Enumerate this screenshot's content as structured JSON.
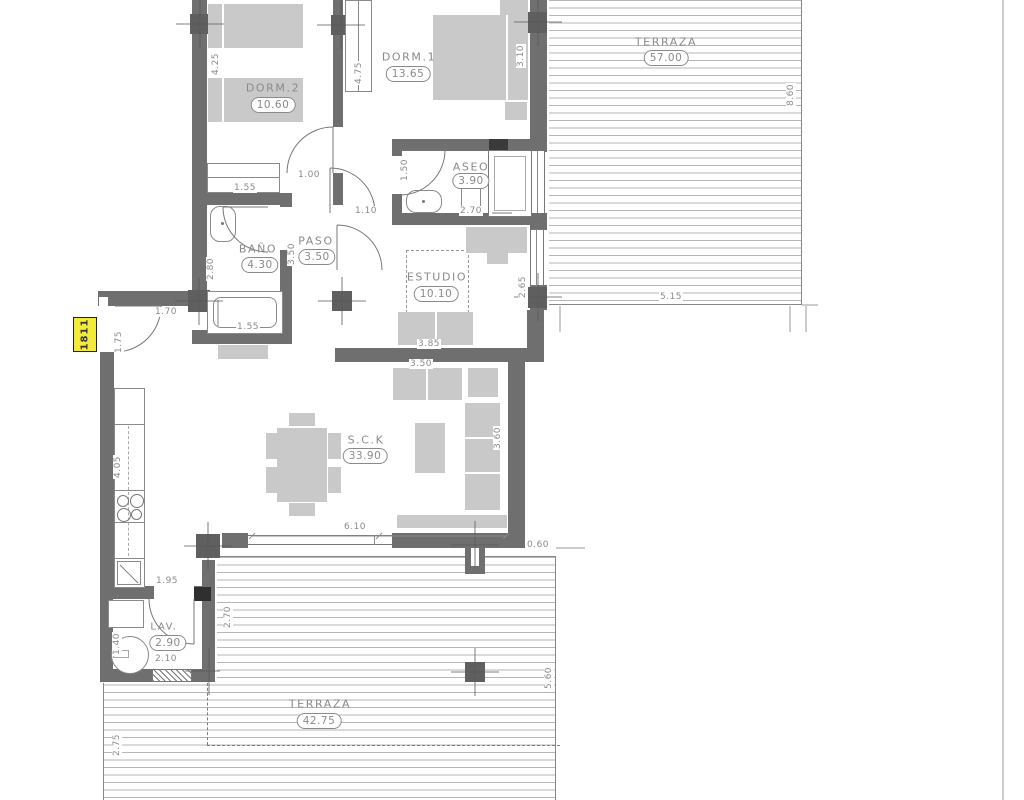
{
  "plan": {
    "unit_tag": "1811",
    "rooms": {
      "dorm2": {
        "name": "DORM.2",
        "area": "10.60"
      },
      "dorm1": {
        "name": "DORM.1",
        "area": "13.65"
      },
      "terraza_top": {
        "name": "TERRAZA",
        "area": "57.00"
      },
      "aseo": {
        "name": "ASEO",
        "area": "3.90"
      },
      "bano": {
        "name": "BAÑO",
        "area": "4.30"
      },
      "paso": {
        "name": "PASO",
        "area": "3.50"
      },
      "estudio": {
        "name": "ESTUDIO",
        "area": "10.10"
      },
      "sck": {
        "name": "S.C.K",
        "area": "33.90"
      },
      "lav": {
        "name": "LAV.",
        "area": "2.90"
      },
      "terraza_bottom": {
        "name": "TERRAZA",
        "area": "42.75"
      }
    },
    "dims": {
      "dorm2_depth": "4.25",
      "dorm1_wardrobe": "4.75",
      "dorm1_width": "3.10",
      "terraza_top_depth": "8.60",
      "terraza_top_width": "5.15",
      "dorm2_closet": "1.55",
      "dorm2_door": "1.00",
      "dorm1_door": "1.10",
      "aseo_door": "1.50",
      "aseo_width": "2.70",
      "bano_depth": "2.80",
      "bano_tub": "1.55",
      "paso_length": "3.50",
      "estudio_window": "2.65",
      "estudio_width": "3.85",
      "sck_sofa": "3.50",
      "sck_depth": "3.60",
      "sck_window": "6.10",
      "overhang": "0.60",
      "entry_door": "1.70",
      "entry_side": "1.75",
      "kitchen_run": "4.05",
      "kitchen_pass": "1.95",
      "lav_side": "2.70",
      "lav_width": "2.10",
      "lav_machine": "1.40",
      "terraza_bottom_depth": "5.60",
      "terraza_bottom_left": "2.75"
    },
    "colors": {
      "wall": "#6f6f6f",
      "furniture": "#c9c9c9",
      "tag_bg": "#f2eb3c",
      "deck_line": "#b6b6b6",
      "label": "#8a8a8a"
    }
  }
}
